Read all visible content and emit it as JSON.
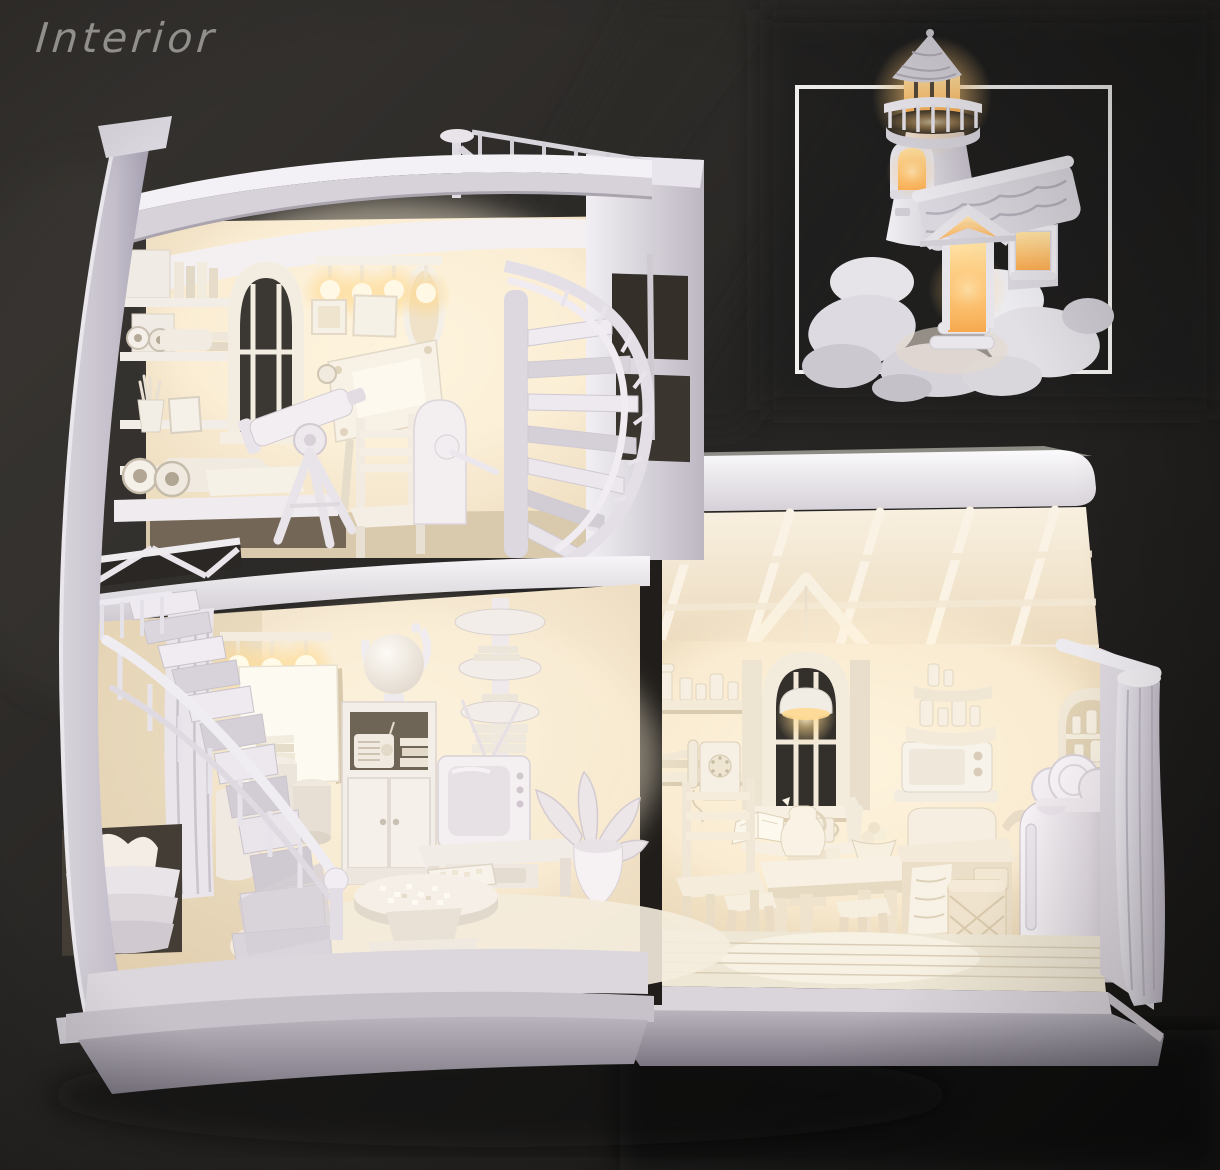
{
  "page": {
    "title": "Interior"
  },
  "colors": {
    "background_top_left": "#33312d",
    "background_right": "#1e1d1c",
    "background_bottom": "#131211",
    "title_text": "#918f8c",
    "inset_frame": "#f2f1f0",
    "model_highlight": "#f6f3f6",
    "model_midtone": "#d6d1d8",
    "model_shadow": "#a39daa",
    "interior_warm_light": "#fdf3df",
    "interior_warm_deep": "#e5cfae",
    "lamp_glow": "#ffd98f",
    "window_dark": "#3a3733"
  },
  "scene": {
    "description": "lighthouse-dollhouse-cutaway-render",
    "inset": {
      "subject": "lighthouse-exterior-on-rocks"
    },
    "rooms": [
      {
        "name": "observatory-study",
        "objects": [
          "roof-walkway-railing",
          "mast",
          "bookshelves",
          "map-scrolls",
          "pencil-cup",
          "picture-frame",
          "arched-window",
          "wall-lamp-bulbs",
          "oval-mirror",
          "drafting-table",
          "chair",
          "telescope",
          "tripod",
          "stair-gate",
          "spiral-staircase"
        ]
      },
      {
        "name": "living-room",
        "objects": [
          "spiral-staircase",
          "railing",
          "curtain",
          "wall-lamp-bulbs",
          "blank-canvas",
          "globe",
          "cabinet",
          "radio",
          "books",
          "corner-shelf-column",
          "television",
          "antenna",
          "tv-bench",
          "potted-plant",
          "coffee-table",
          "puzzle-pieces",
          "puzzle-box",
          "drum-stools",
          "cushion-baskets",
          "round-rug"
        ]
      },
      {
        "name": "kitchen",
        "objects": [
          "truss-roof",
          "gable",
          "arched-window",
          "pendant-lamp",
          "shelf-jars",
          "wall-phone",
          "window-console",
          "open-book",
          "mug",
          "pitcher",
          "fruit-bowl",
          "dining-table",
          "stools",
          "chair",
          "counter-sink",
          "faucet",
          "towel",
          "wicker-hamper",
          "refrigerator",
          "plate-rack",
          "microwave",
          "corner-etagere",
          "arched-niche",
          "curtain",
          "plank-floor",
          "base-plinth"
        ]
      }
    ]
  }
}
